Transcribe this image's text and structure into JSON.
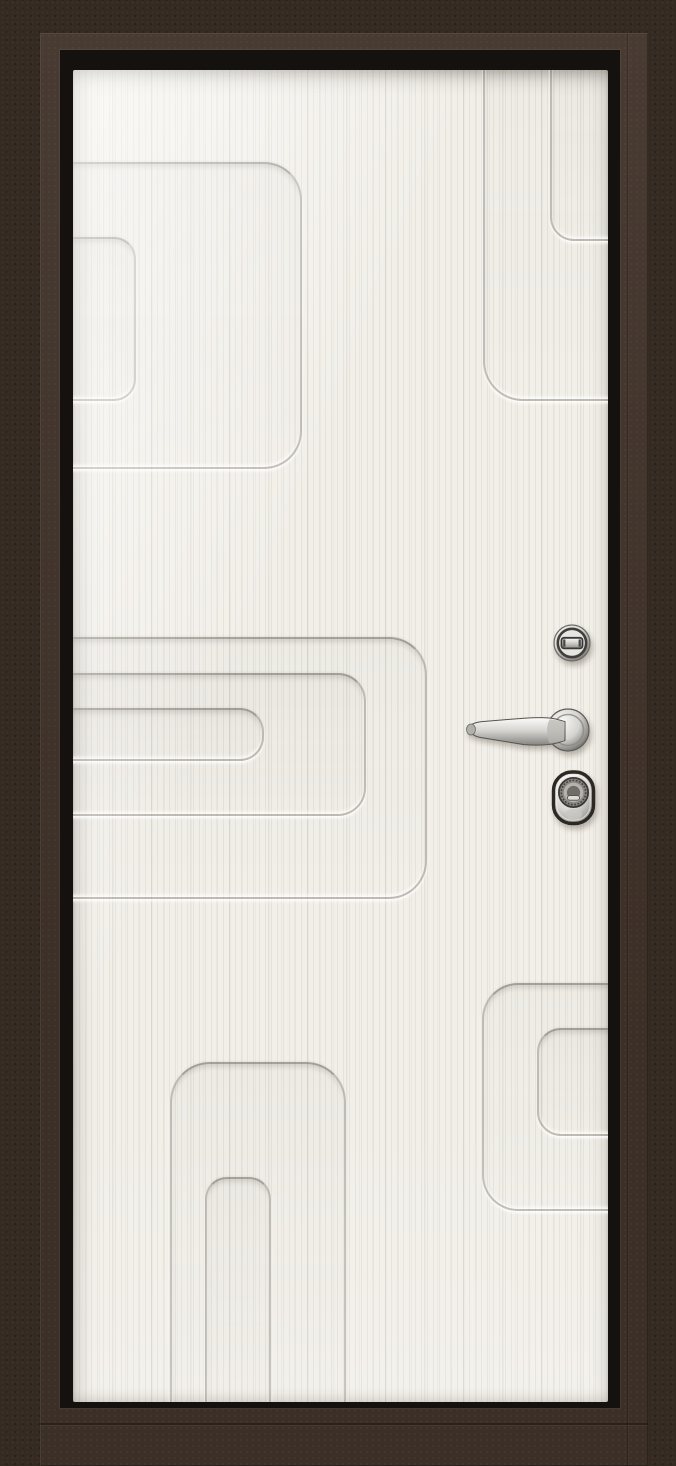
{
  "meta": {
    "subject": "Steel entry door, interior side, closed",
    "view": "straight-on product photo",
    "visible_text": ""
  },
  "door": {
    "frame": {
      "name": "door frame and leaf edge",
      "finish": "textured dark chocolate brown (wenge) powder coat"
    },
    "seal": {
      "name": "black perimeter seal contour"
    },
    "panel": {
      "name": "decorative inner panel",
      "finish": "white woodgrain (bianco) laminate with vertical grain",
      "pattern": "recessed grooves forming offset concentric rounded rectangles",
      "pattern_groups": [
        {
          "name": "top-left",
          "shapes": 2,
          "attached_to": "left edge"
        },
        {
          "name": "top-right",
          "shapes": 2,
          "attached_to": "top and right edges"
        },
        {
          "name": "middle-left",
          "shapes": 3,
          "attached_to": "left edge"
        },
        {
          "name": "bottom-center-arches",
          "shapes": 2,
          "attached_to": "bottom edge"
        },
        {
          "name": "bottom-right",
          "shapes": 2,
          "attached_to": "right edge"
        }
      ]
    },
    "hardware": [
      {
        "name": "thumbturn-knob",
        "label": "Round thumbturn lock",
        "finish": "polished chrome"
      },
      {
        "name": "lever-handle",
        "label": "Lever handle on round rosette",
        "finish": "polished chrome",
        "orientation": "pointing left"
      },
      {
        "name": "cylinder-lock",
        "label": "Oval cylinder lock escutcheon",
        "finish": "chrome with dark trim"
      }
    ]
  },
  "colors": {
    "wall_brown": "#352a22",
    "frame_face_brown": "#41332a",
    "seal_black": "#15110f",
    "panel_white": "#f2efe9",
    "groove_line": "#a49e93",
    "chrome_light": "#f2f2f0",
    "chrome_dark": "#8d8b86"
  }
}
